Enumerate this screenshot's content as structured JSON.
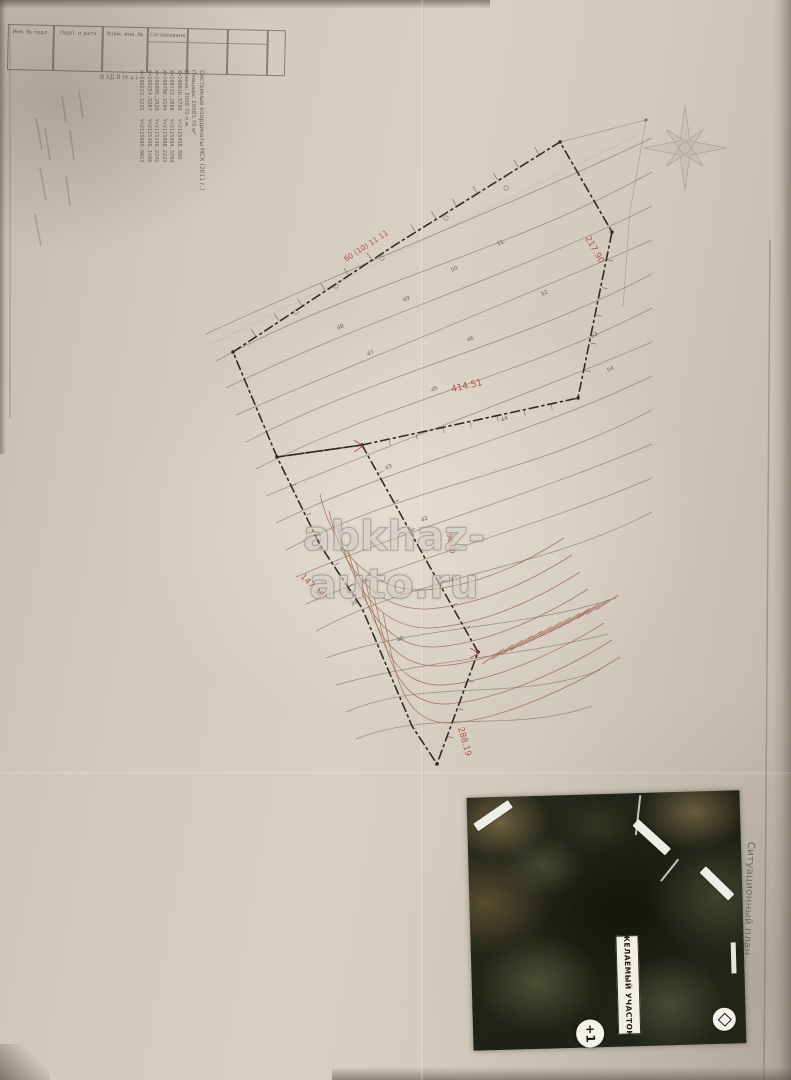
{
  "meta": {
    "watermark": "abkhaz-auto.ru",
    "caption_vertical": "Ситуационный план"
  },
  "stamp": {
    "cells": [
      "Инв. № подл.",
      "Подп. и дата",
      "Взам. инв. №",
      "Согласовано"
    ]
  },
  "coord_block": {
    "note": "В УД В (х.у.) —",
    "title": "Системные координаты МСК (2011 г.)",
    "area": "Площадь: 20083.70 м²",
    "length": "Длина: 3008.70 п.м.",
    "points": [
      {
        "x": "X=190816.5705",
        "y": "Y=2115458.500"
      },
      {
        "x": "X=190722.2868",
        "y": "Y=2115064.3704"
      },
      {
        "x": "X=190786.8104",
        "y": "Y=2115088.2223"
      },
      {
        "x": "X=190805.2920",
        "y": "Y=2115190.2242"
      },
      {
        "x": "X=190254.8287",
        "y": "Y=2115306.1606"
      },
      {
        "x": "X=190223.5222",
        "y": "Y=2115080.0813"
      }
    ]
  },
  "map": {
    "boundary_color": "#332c24",
    "dimension_color": "#a64a3c",
    "contour_color": "#8b7c6b",
    "dims": [
      "60 (10) 11 11",
      "217.90",
      "414.51",
      "147.38",
      "288.19",
      "90.60"
    ],
    "elev": [
      "48",
      "47",
      "49",
      "50",
      "51",
      "52",
      "46",
      "45",
      "44",
      "43",
      "42",
      "41",
      "40",
      "39",
      "53",
      "54"
    ]
  },
  "inset": {
    "label": "ЖЕЛАЕМЫЙ УЧАСТОК",
    "marker1": "+1"
  }
}
